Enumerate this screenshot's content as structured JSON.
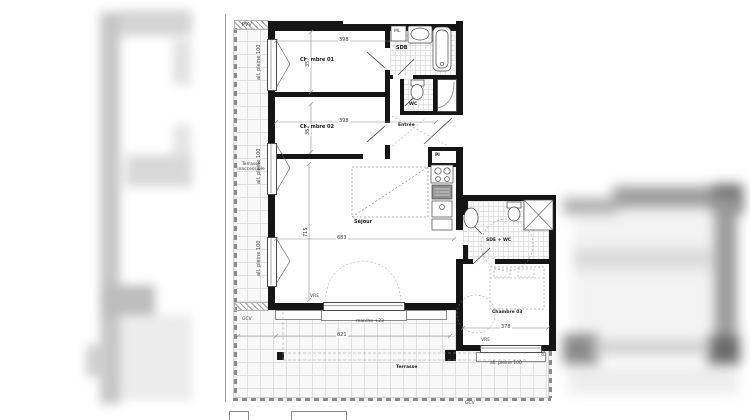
{
  "floorplan": {
    "rooms": {
      "chambre1": {
        "name": "Chambre 01",
        "width_cm": "398",
        "depth_cm": "357"
      },
      "chambre2": {
        "name": "Chambre 02",
        "width_cm": "398",
        "depth_cm": "352"
      },
      "chambre3": {
        "name": "Chambre 03",
        "width_cm": "378"
      },
      "sejour": {
        "name": "Séjour",
        "width_cm": "683",
        "depth_cm": "715"
      },
      "sdb": {
        "name": "SDB"
      },
      "wc": {
        "name": "WC"
      },
      "sde_wc": {
        "name": "SDE + WC"
      },
      "entree": {
        "name": "Entrée"
      },
      "placard": {
        "name": "Pl"
      },
      "terrasse": {
        "name": "Terrasse",
        "width_cm": "821"
      },
      "terrasse_inaccessible": {
        "name_line1": "Terrasse",
        "name_line2": "inaccessible"
      }
    },
    "fixtures": {
      "washing_machine": "ML"
    },
    "annotations": {
      "step": "marche +23",
      "window_sill": "all. pleine 100",
      "vre": "VRE",
      "pvv": "PVV",
      "gcv": "GCV"
    }
  }
}
